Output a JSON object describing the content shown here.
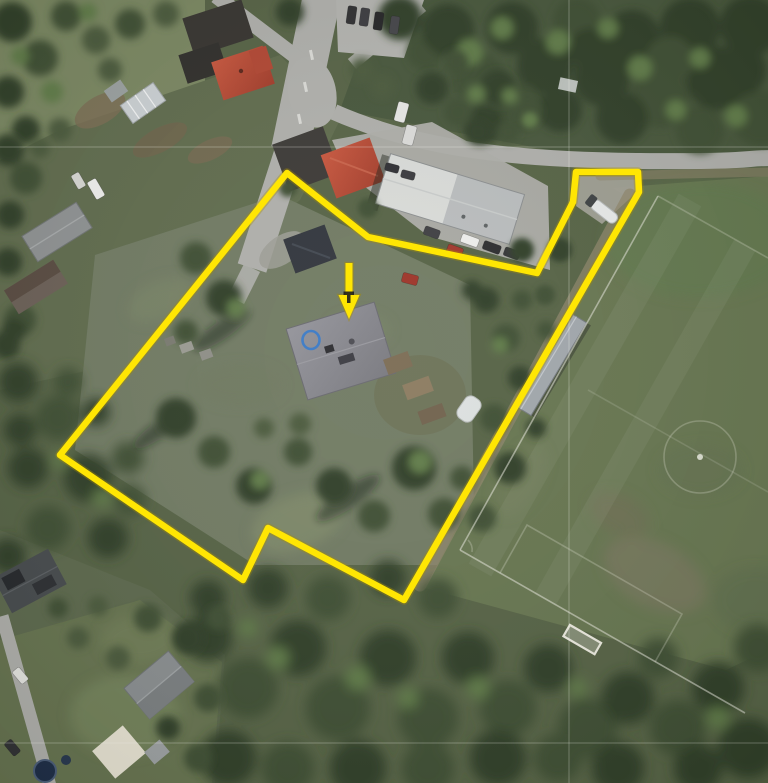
{
  "annotations": {
    "boundary": {
      "shape": "polygon",
      "points": "287,173 368,237 537,273 573,202 576,172 638,172 639,192 404,600 268,528 243,580 60,455",
      "color": "#ffe603",
      "width": 6.5
    },
    "arrow": {
      "shape": "down-arrow",
      "points": "345.5,263 352.5,263 352.5,295 359.5,295 349,319 338.5,295 345.5,295",
      "color": "#ffe603",
      "outline_color": "#a98f00"
    },
    "arrow_tick": {
      "shape": "t-mark",
      "points": "343.5,291.5 354,291.5 354,295 350.5,295 350.5,303 347,303 347,295 343.5,295",
      "color": "#1d1d1d"
    },
    "circle": {
      "shape": "ellipse",
      "cx": 311,
      "cy": 340,
      "rx": 8.5,
      "ry": 9,
      "color": "#3f7ec9",
      "width": 2.6
    }
  },
  "palette": {
    "forest_dark": "#2e3c27",
    "meadow": "#707a62",
    "field_green": "#66754f",
    "road_gray": "#afafab",
    "warehouse_roof": "#d9dbd8",
    "red_roof": "#b5432f",
    "gray_roof": "#8e8e92"
  }
}
